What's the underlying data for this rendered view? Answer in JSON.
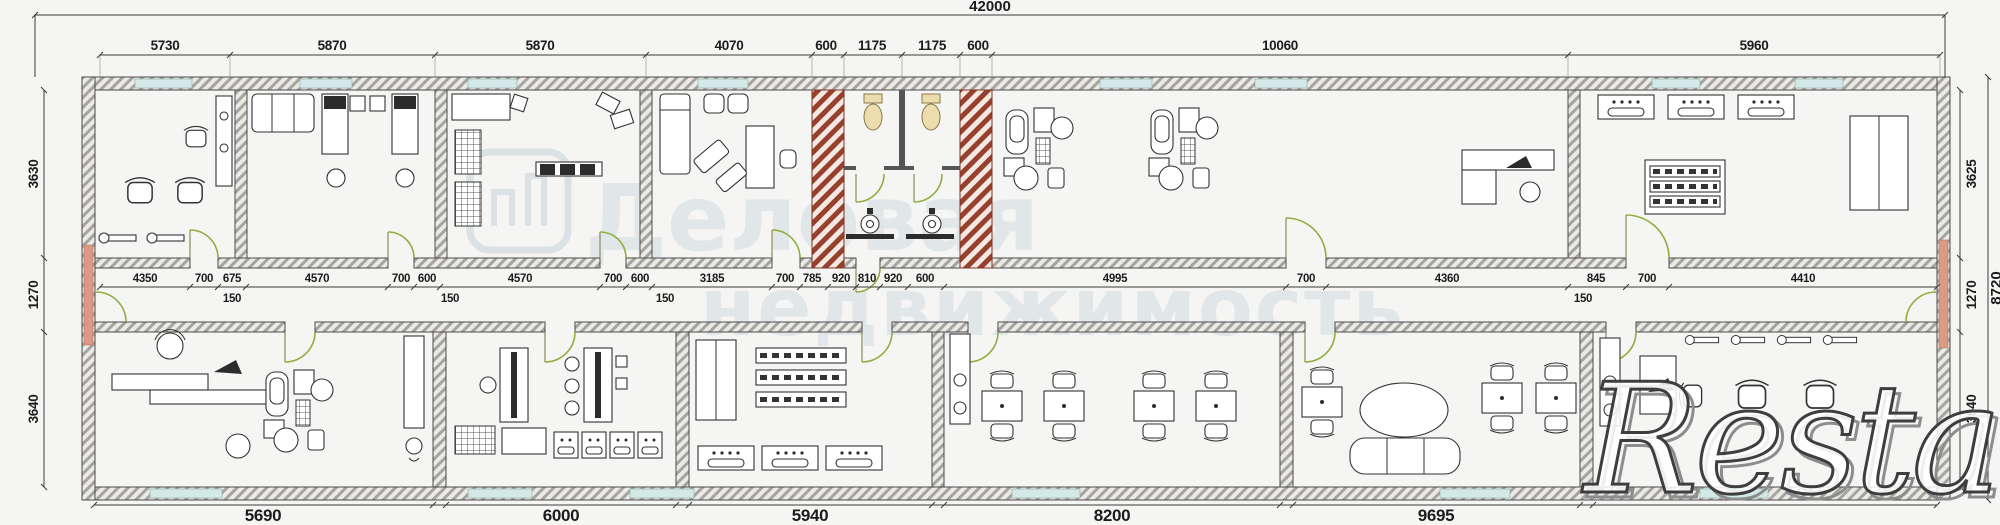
{
  "wm": {
    "line1": "Деловая",
    "line2": "недвижимость",
    "brand": "Restate"
  },
  "dims": {
    "overall": "42000",
    "top": [
      "5730",
      "5870",
      "5870",
      "4070",
      "600",
      "1175",
      "1175",
      "600",
      "10060",
      "5960"
    ],
    "left": [
      "3630",
      "1270",
      "3640"
    ],
    "right": [
      "3625",
      "1270",
      "3640"
    ],
    "right_total": "8720",
    "chain": [
      "4350",
      "700",
      "675",
      "4570",
      "700",
      "600",
      "4570",
      "700",
      "600",
      "3185",
      "700",
      "785",
      "920",
      "810",
      "920",
      "600",
      "4995",
      "700",
      "4360",
      "845",
      "700",
      "4410"
    ],
    "offset150": [
      "150",
      "150",
      "150",
      "150"
    ],
    "bottom": [
      "5690",
      "6000",
      "5940",
      "8200",
      "9695"
    ]
  },
  "colors": {
    "wall_hatch": "#a6a49e",
    "wall_stroke": "#4c4c4c",
    "shaft_red": "#96402d",
    "window_glass": "#d3e9e7",
    "door_green": "#8fae3e",
    "door_red": "#dc9a85",
    "toilet_tan": "#ecdcae",
    "dim_text": "#1c1c1c",
    "watermark_gray": "#c6d2da"
  }
}
